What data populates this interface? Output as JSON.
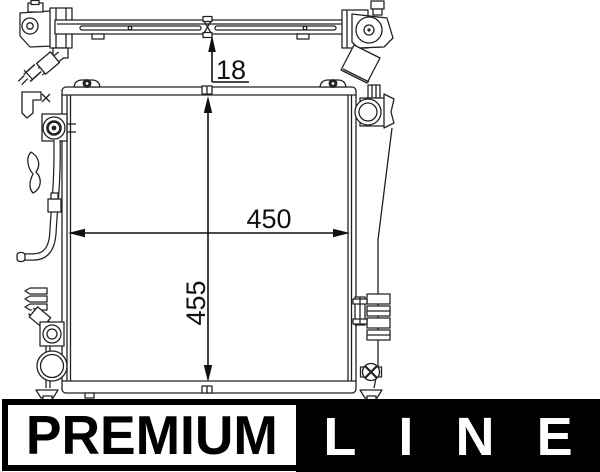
{
  "dimensions": [
    {
      "name": "crossmember-thickness",
      "value": "18"
    },
    {
      "name": "core-width",
      "value": "450"
    },
    {
      "name": "core-height",
      "value": "455"
    }
  ],
  "banner": {
    "premium_label": "PREMIUM",
    "line_label": "LINE",
    "colors": {
      "band_bg": "#000000",
      "premium_box_bg": "#ffffff",
      "premium_text": "#000000",
      "line_text": "#ffffff"
    }
  },
  "drawing": {
    "line_color": "#222222",
    "background": "#ffffff"
  }
}
